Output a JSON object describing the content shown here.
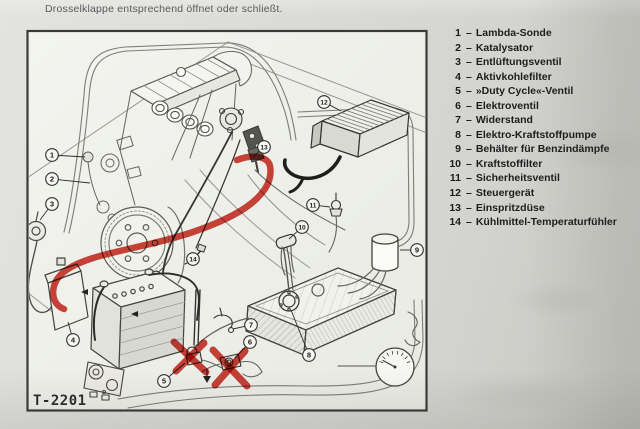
{
  "caption": "Drosselklappe entsprechend öffnet oder schließt.",
  "figure": {
    "code": "T-2201",
    "legend": [
      {
        "num": "1",
        "label": "Lambda-Sonde"
      },
      {
        "num": "2",
        "label": "Katalysator"
      },
      {
        "num": "3",
        "label": "Entlüftungsventil"
      },
      {
        "num": "4",
        "label": "Aktivkohlefilter"
      },
      {
        "num": "5",
        "label": "»Duty Cycle«-Ventil"
      },
      {
        "num": "6",
        "label": "Elektroventil"
      },
      {
        "num": "7",
        "label": "Widerstand"
      },
      {
        "num": "8",
        "label": "Elektro-Kraftstoffpumpe"
      },
      {
        "num": "9",
        "label": "Behälter für Benzindämpfe"
      },
      {
        "num": "10",
        "label": "Kraftstoffilter"
      },
      {
        "num": "11",
        "label": "Sicherheitsventil"
      },
      {
        "num": "12",
        "label": "Steuergerät"
      },
      {
        "num": "13",
        "label": "Einspritzdüse"
      },
      {
        "num": "14",
        "label": "Kühlmittel-Temperaturfühler"
      }
    ],
    "callouts": [
      {
        "num": "1",
        "cx": 52,
        "cy": 155,
        "tx": 85,
        "ty": 157
      },
      {
        "num": "2",
        "cx": 52,
        "cy": 179,
        "tx": 90,
        "ty": 183
      },
      {
        "num": "3",
        "cx": 52,
        "cy": 204,
        "tx": 40,
        "ty": 220
      },
      {
        "num": "4",
        "cx": 73,
        "cy": 340,
        "tx": 68,
        "ty": 322
      },
      {
        "num": "5",
        "cx": 164,
        "cy": 381,
        "tx": 185,
        "ty": 363
      },
      {
        "num": "6",
        "cx": 250,
        "cy": 342,
        "tx": 235,
        "ty": 358
      },
      {
        "num": "7",
        "cx": 251,
        "cy": 325,
        "tx": 233,
        "ty": 329
      },
      {
        "num": "8",
        "cx": 309,
        "cy": 355,
        "tx": 291,
        "ty": 310
      },
      {
        "num": "9",
        "cx": 417,
        "cy": 250,
        "tx": 400,
        "ty": 250
      },
      {
        "num": "10",
        "cx": 302,
        "cy": 227,
        "tx": 289,
        "ty": 239
      },
      {
        "num": "11",
        "cx": 313,
        "cy": 205,
        "tx": 330,
        "ty": 207
      },
      {
        "num": "12",
        "cx": 324,
        "cy": 102,
        "tx": 341,
        "ty": 111
      },
      {
        "num": "13",
        "cx": 264,
        "cy": 147,
        "tx": 253,
        "ty": 157
      },
      {
        "num": "14",
        "cx": 193,
        "cy": 259,
        "tx": 201,
        "ty": 251
      }
    ]
  },
  "annotations": {
    "color": "#c92418",
    "strokes": [
      {
        "d": "M237,160 C252,154 268,156 270,166 C272,177 268,186 261,194 C248,210 222,222 193,232 C158,244 118,250 93,258 C74,264 58,272 54,286 C51,298 56,306 64,309",
        "w": 6.5
      },
      {
        "d": "M174,342 L206,372",
        "w": 7
      },
      {
        "d": "M204,343 L176,371",
        "w": 7
      },
      {
        "d": "M213,350 L247,386",
        "w": 7
      },
      {
        "d": "M245,351 L215,385",
        "w": 7
      }
    ]
  }
}
